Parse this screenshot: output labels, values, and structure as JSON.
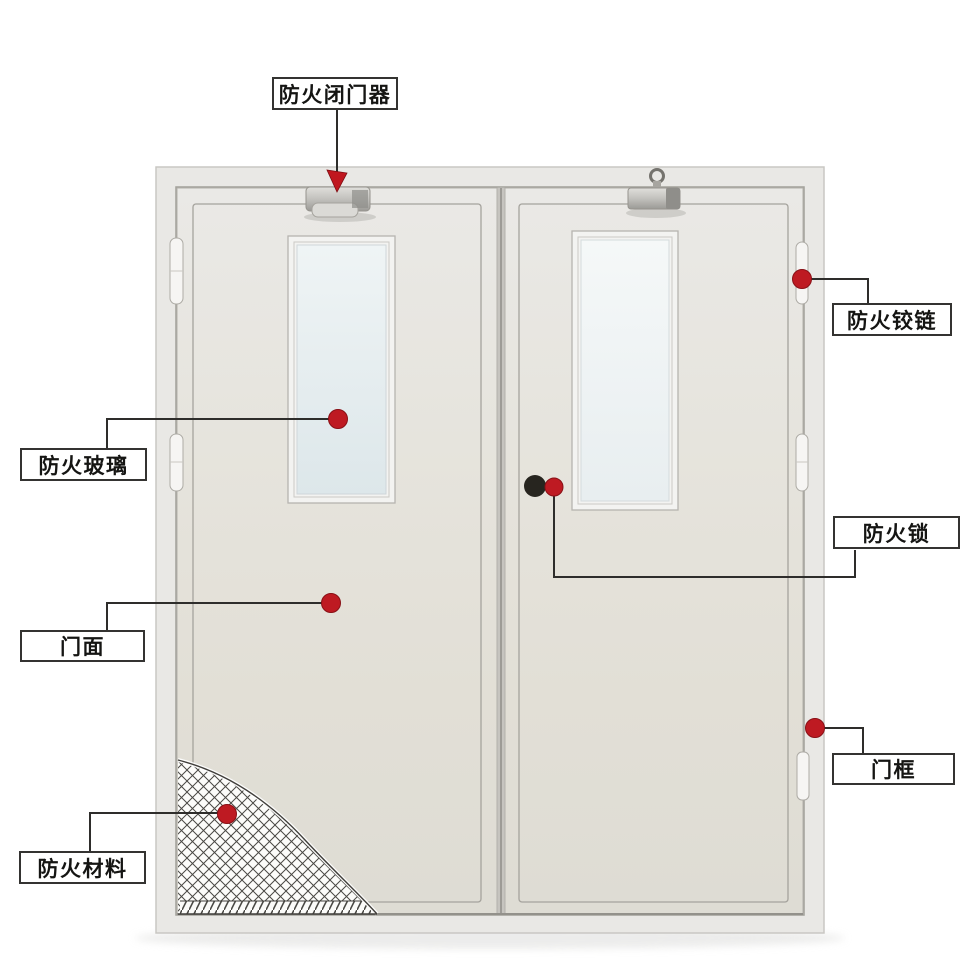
{
  "figure": {
    "kind": "annotated fire-door parts diagram",
    "labels": {
      "door_closer": "防火闭门器",
      "fire_hinge": "防火铰链",
      "fire_glass": "防火玻璃",
      "fire_lock": "防火锁",
      "door_face": "门面",
      "door_frame": "门框",
      "fire_material": "防火材料"
    },
    "colors": {
      "background": "#ffffff",
      "door_leaf": "#e5e3dc",
      "door_frame_face": "#e9e8e5",
      "window_glass": "#e9f1f3",
      "marker_red": "#be1a22",
      "lock_black": "#27251f",
      "leader_line": "#2e2d2b",
      "label_border": "#343331"
    }
  }
}
